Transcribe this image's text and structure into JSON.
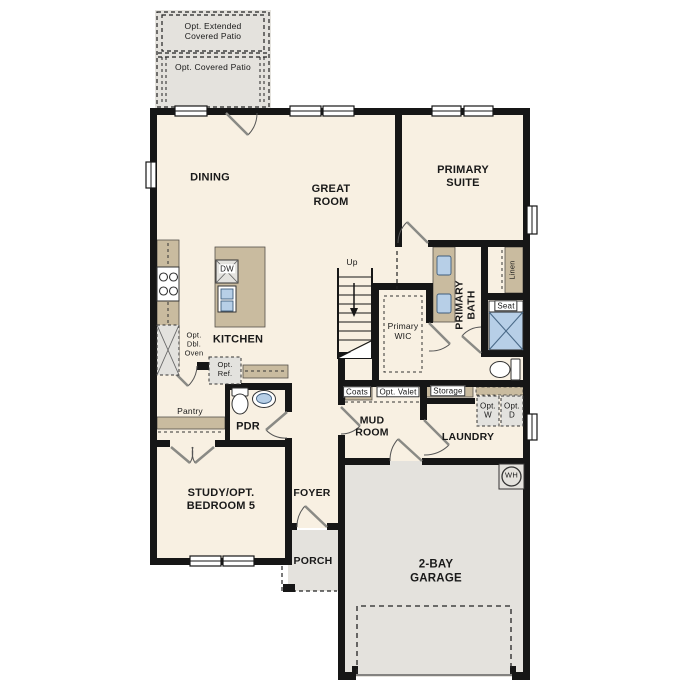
{
  "plan": {
    "type": "first-floor-plan",
    "labels": {
      "opt_extended_patio": "Opt. Extended\nCovered Patio",
      "opt_covered_patio": "Opt. Covered Patio",
      "dining": "DINING",
      "great_room": "GREAT\nROOM",
      "primary_suite": "PRIMARY\nSUITE",
      "kitchen": "KITCHEN",
      "dw": "DW",
      "opt_dbl_oven": "Opt.\nDbl.\nOven",
      "opt_ref": "Opt.\nRef.",
      "pantry": "Pantry",
      "pdr": "PDR",
      "up": "Up",
      "primary_wic": "Primary\nWIC",
      "primary_bath": "PRIMARY\nBATH",
      "linen": "Linen",
      "seat": "Seat",
      "coats": "Coats",
      "opt_valet": "Opt. Valet",
      "storage": "Storage",
      "opt_w": "Opt.\nW",
      "opt_d": "Opt.\nD",
      "mud_room": "MUD\nROOM",
      "laundry": "LAUNDRY",
      "study": "STUDY/OPT.\nBEDROOM 5",
      "foyer": "FOYER",
      "porch": "PORCH",
      "garage": "2-BAY\nGARAGE",
      "wh": "WH"
    },
    "colors": {
      "wall": "#161616",
      "floor": "#f8f0e2",
      "outdoor": "#e4e2dd",
      "cabinet": "#c9bb9f",
      "fixture_blue": "#b7cfe7",
      "appliance_gray": "#e3e2de"
    }
  }
}
